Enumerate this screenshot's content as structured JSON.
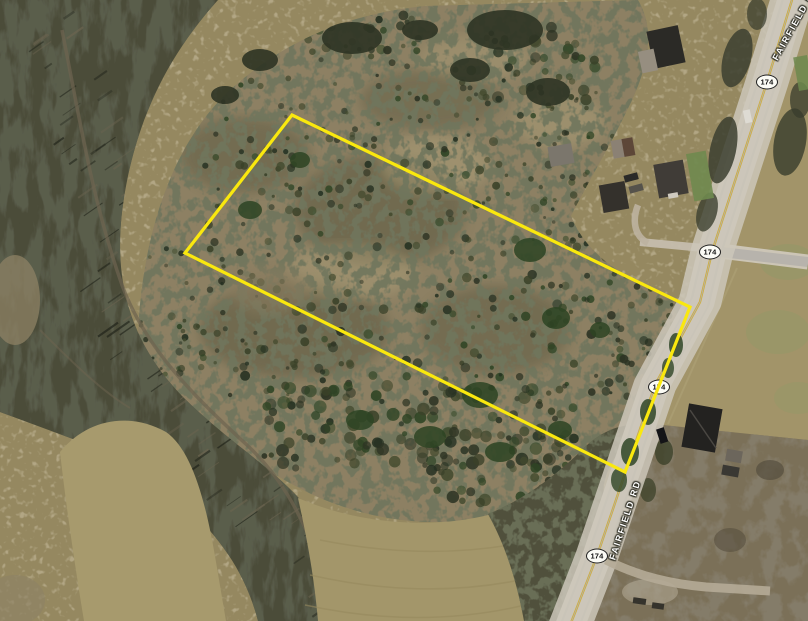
{
  "map": {
    "road": {
      "name_labels": [
        {
          "id": "fairfield-rd-top",
          "text": "FAIRFIELD RD"
        },
        {
          "id": "fairfield-rd-lower",
          "text": "FAIRFIELD RD"
        }
      ],
      "route_shields": [
        {
          "text": "174"
        },
        {
          "text": "174"
        },
        {
          "text": "174"
        },
        {
          "text": "174"
        }
      ]
    },
    "parcel": {
      "outline_color": "#fae80e"
    }
  }
}
